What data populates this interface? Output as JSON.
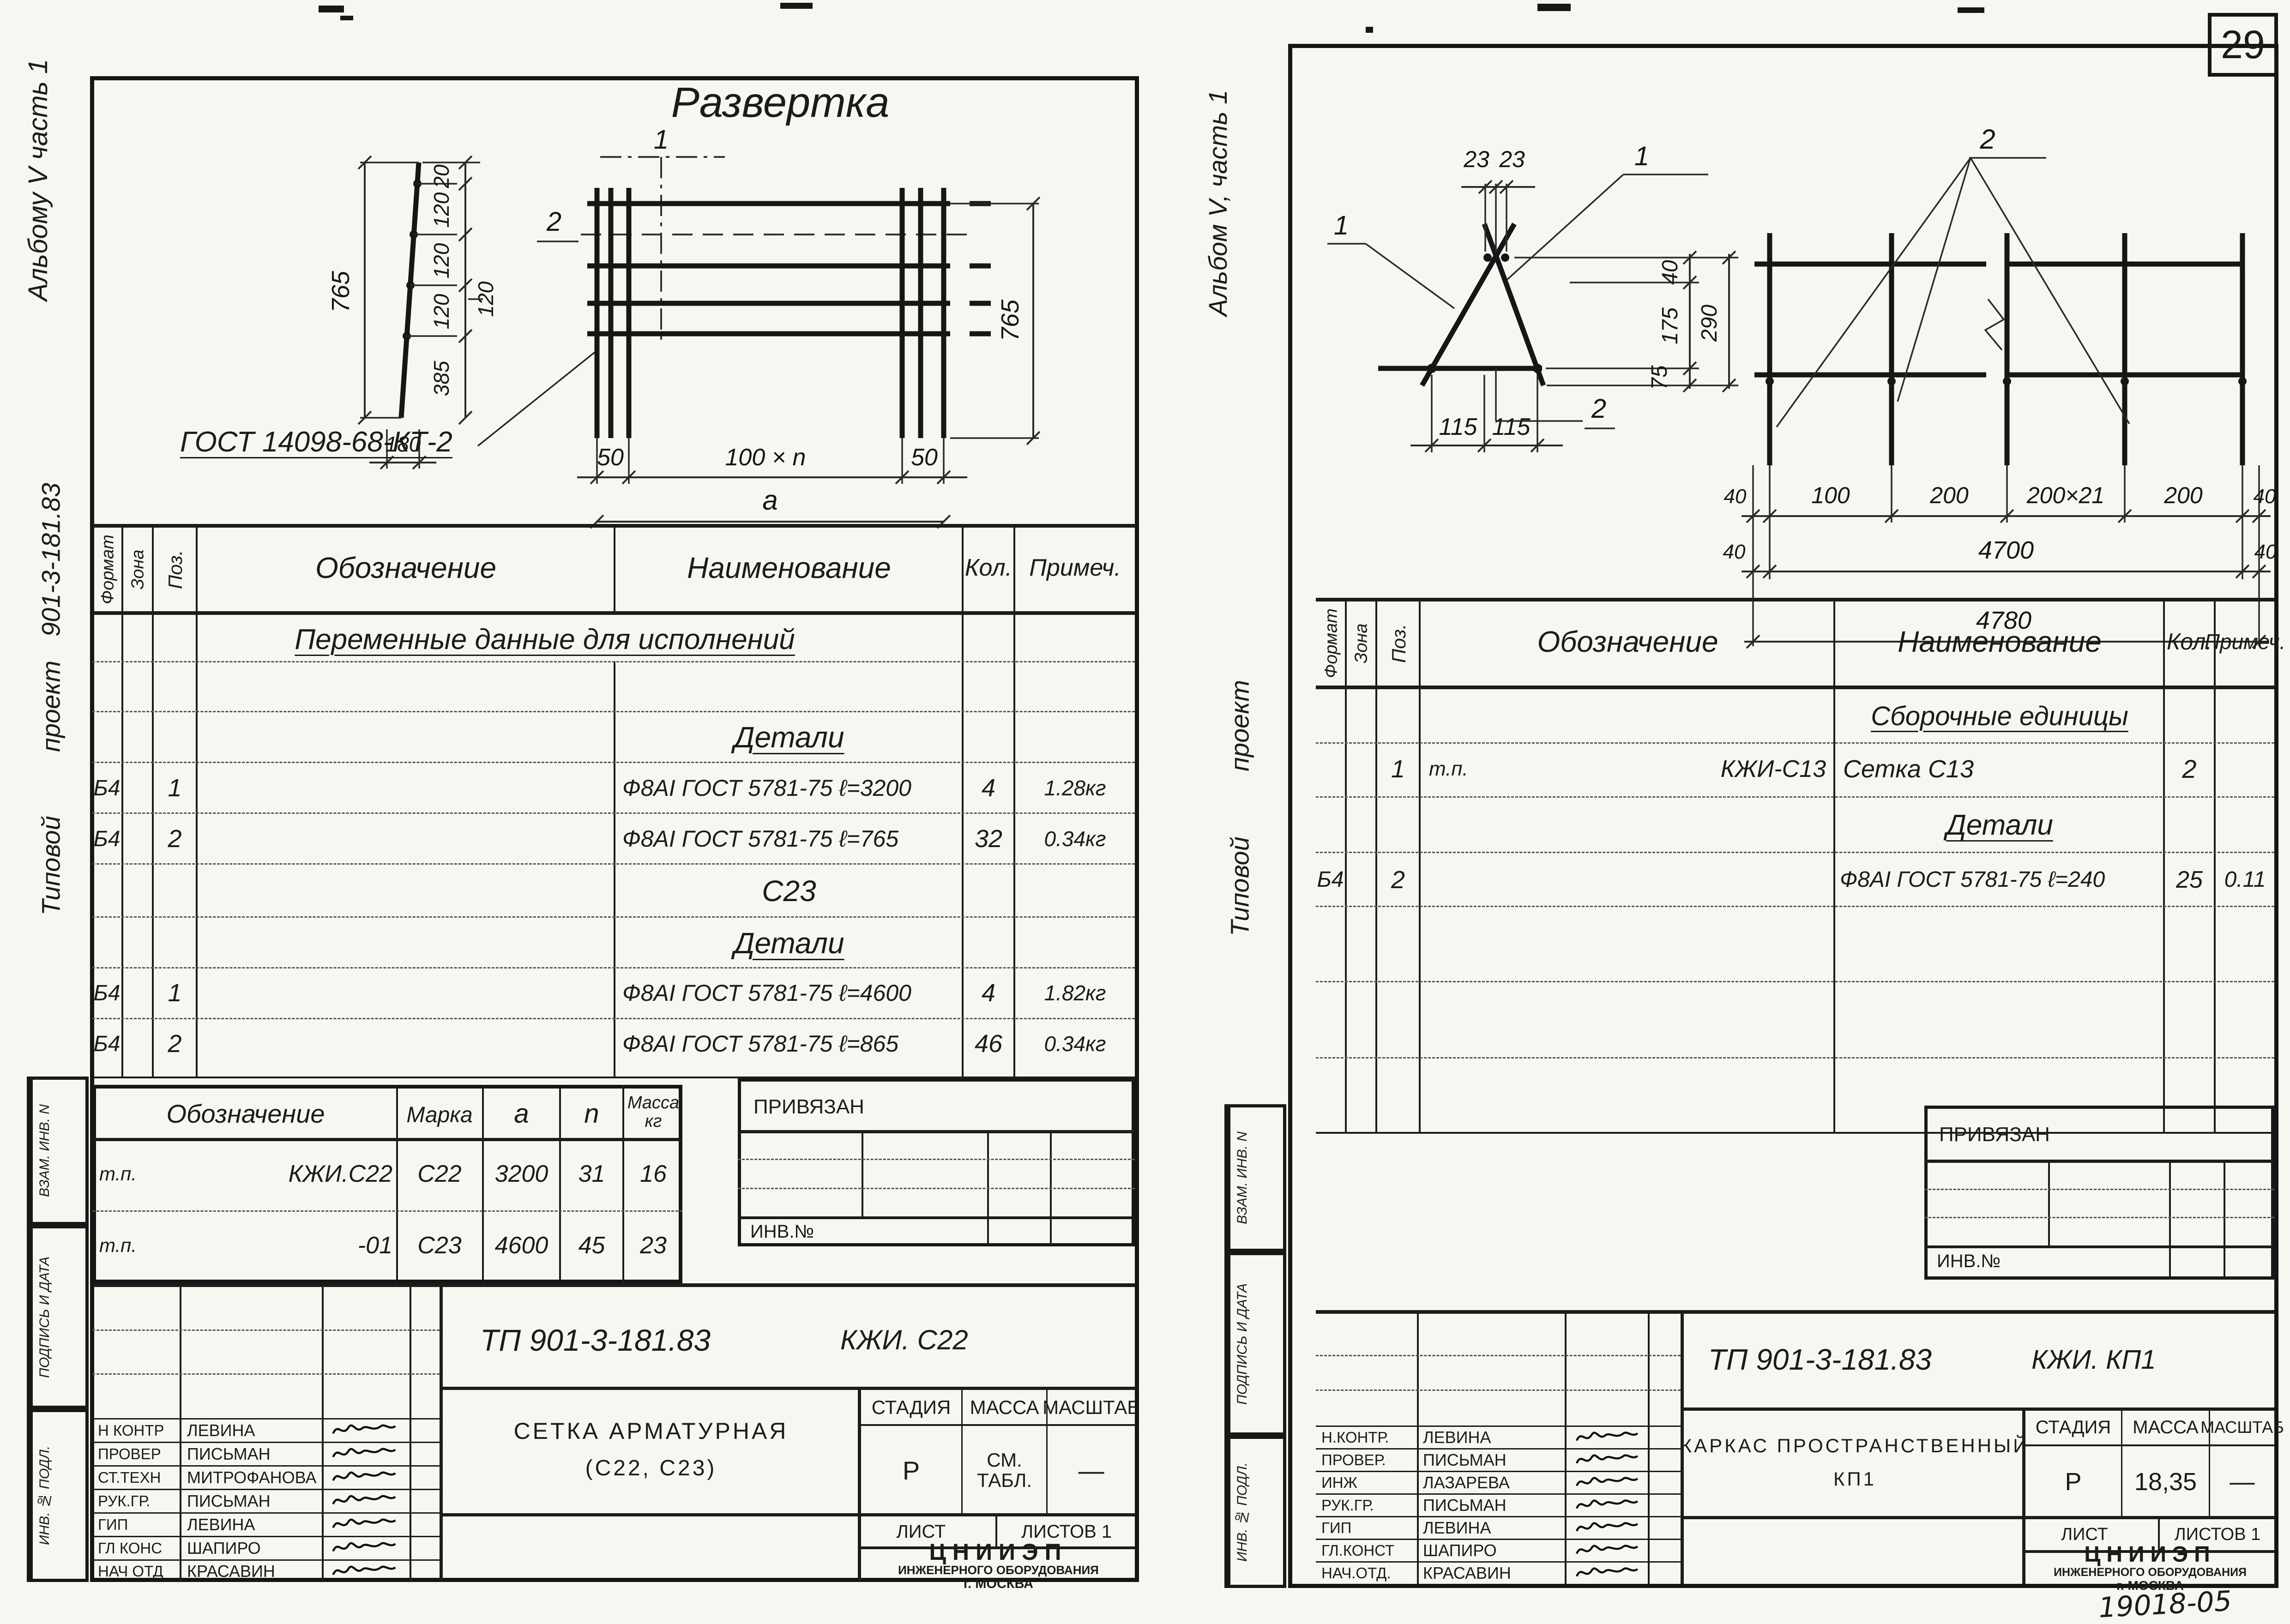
{
  "page": {
    "number": "29",
    "stamp_note": "19018-05"
  },
  "labels": {
    "privyazan": "ПРИВЯЗАН",
    "inv_no": "ИНВ.№",
    "margin_box1": "ВЗАМ. ИНВ. N",
    "margin_box2": "ПОДПИСЬ И ДАТА",
    "margin_box3": "ИНВ. № ПОДЛ.",
    "org1": "ЦНИИЭП",
    "org2": "ИНЖЕНЕРНОГО ОБОРУДОВАНИЯ",
    "org3": "г. МОСКВА",
    "stage": "СТАДИЯ",
    "mass": "МАССА",
    "scale": "МАСШТАБ",
    "sheet": "ЛИСТ",
    "sheets": "ЛИСТОВ 1",
    "col_format": "Формат",
    "col_zone": "Зона",
    "col_pos": "Поз.",
    "col_oboz": "Обозначение",
    "col_naim": "Наименование",
    "col_kol": "Кол.",
    "col_prim": "Примеч."
  },
  "left": {
    "margin_album": "Альбому V часть 1",
    "margin_tipovoy": "Типовой",
    "margin_proekt": "проект",
    "margin_number": "901-3-181.83",
    "drawing": {
      "title": "Развертка",
      "gost": "ГОСТ 14098-68-КТ-2",
      "callout1": "1",
      "callout2": "2",
      "dims": {
        "h765": "765",
        "s20": "20",
        "s120a": "120",
        "s120b": "120",
        "s120c": "120",
        "s385": "385",
        "inner120": "120",
        "w180": "180",
        "l50": "50",
        "span": "100 × n",
        "r50": "50",
        "a": "a",
        "r765": "765"
      }
    },
    "spec": {
      "section": "Переменные данные для исполнений",
      "details1": "Детали",
      "rows1": [
        {
          "f": "Б4",
          "pos": "1",
          "naim": "Ф8АI ГОСТ 5781-75   ℓ=3200",
          "kol": "4",
          "prim": "1.28кг"
        },
        {
          "f": "Б4",
          "pos": "2",
          "naim": "Ф8АI ГОСТ 5781-75   ℓ=765",
          "kol": "32",
          "prim": "0.34кг"
        }
      ],
      "group2": "С23",
      "details2": "Детали",
      "rows2": [
        {
          "f": "Б4",
          "pos": "1",
          "naim": "Ф8АI ГОСТ 5781-75   ℓ=4600",
          "kol": "4",
          "prim": "1.82кг"
        },
        {
          "f": "Б4",
          "pos": "2",
          "naim": "Ф8АI ГОСТ 5781-75   ℓ=865",
          "kol": "46",
          "prim": "0.34кг"
        }
      ]
    },
    "param": {
      "h_oboz": "Обозначение",
      "h_marka": "Марка",
      "h_a": "a",
      "h_n": "n",
      "h_massa1": "Масса",
      "h_massa2": "кг",
      "rows": [
        {
          "o1": "т.п.",
          "o2": "КЖИ.С22",
          "marka": "С22",
          "a": "3200",
          "n": "31",
          "m": "16"
        },
        {
          "o1": "т.п.",
          "o2": "-01",
          "marka": "С23",
          "a": "4600",
          "n": "45",
          "m": "23"
        }
      ]
    },
    "tb": {
      "doc": "ТП 901-3-181.83",
      "code": "КЖИ. С22",
      "name1": "СЕТКА  АРМАТУРНАЯ",
      "name2": "(С22, С23)",
      "stage": "Р",
      "mass1": "СМ.",
      "mass2": "ТАБЛ.",
      "scale": "—",
      "people": [
        {
          "role": "Н КОНТР",
          "name": "ЛЕВИНА"
        },
        {
          "role": "ПРОВЕР",
          "name": "ПИСЬМАН"
        },
        {
          "role": "СТ.ТЕХН",
          "name": "МИТРОФАНОВА"
        },
        {
          "role": "РУК.ГР.",
          "name": "ПИСЬМАН"
        },
        {
          "role": "ГИП",
          "name": "ЛЕВИНА"
        },
        {
          "role": "ГЛ КОНС",
          "name": "ШАПИРО"
        },
        {
          "role": "НАЧ ОТД",
          "name": "КРАСАВИН"
        }
      ]
    }
  },
  "right": {
    "margin_album": "Альбом V, часть 1",
    "margin_tipovoy": "Типовой",
    "margin_proekt": "проект",
    "frame_drawing": {
      "callout1l": "1",
      "callout1r": "1",
      "callout2": "2",
      "dims": {
        "d23a": "23",
        "d23b": "23",
        "d40": "40",
        "d175": "175",
        "d75": "75",
        "d290": "290",
        "b115a": "115",
        "b115b": "115"
      }
    },
    "mesh_drawing": {
      "callout2": "2",
      "dims": {
        "e40a": "40",
        "s100": "100",
        "s200a": "200",
        "s200x21": "200×21",
        "s200b": "200",
        "e40b": "40",
        "e40c": "40",
        "e40d": "40",
        "t4700": "4700",
        "t4780": "4780"
      }
    },
    "spec": {
      "assembly": "Сборочные единицы",
      "row1": {
        "pos": "1",
        "o1": "т.п.",
        "o2": "КЖИ-С13",
        "naim": "Сетка С13",
        "kol": "2"
      },
      "details": "Детали",
      "row2": {
        "f": "Б4",
        "pos": "2",
        "naim": "Ф8АI ГОСТ 5781-75  ℓ=240",
        "kol": "25",
        "prim": "0.11"
      }
    },
    "tb": {
      "doc": "ТП 901-3-181.83",
      "code": "КЖИ. КП1",
      "name1": "КАРКАС ПРОСТРАНСТВЕННЫЙ",
      "name2": "КП1",
      "stage": "Р",
      "mass": "18,35",
      "scale": "—",
      "people": [
        {
          "role": "Н.КОНТР.",
          "name": "ЛЕВИНА"
        },
        {
          "role": "ПРОВЕР.",
          "name": "ПИСЬМАН"
        },
        {
          "role": "ИНЖ",
          "name": "ЛАЗАРЕВА"
        },
        {
          "role": "РУК.ГР.",
          "name": "ПИСЬМАН"
        },
        {
          "role": "ГИП",
          "name": "ЛЕВИНА"
        },
        {
          "role": "ГЛ.КОНСТ",
          "name": "ШАПИРО"
        },
        {
          "role": "НАЧ.ОТД.",
          "name": "КРАСАВИН"
        }
      ]
    }
  }
}
